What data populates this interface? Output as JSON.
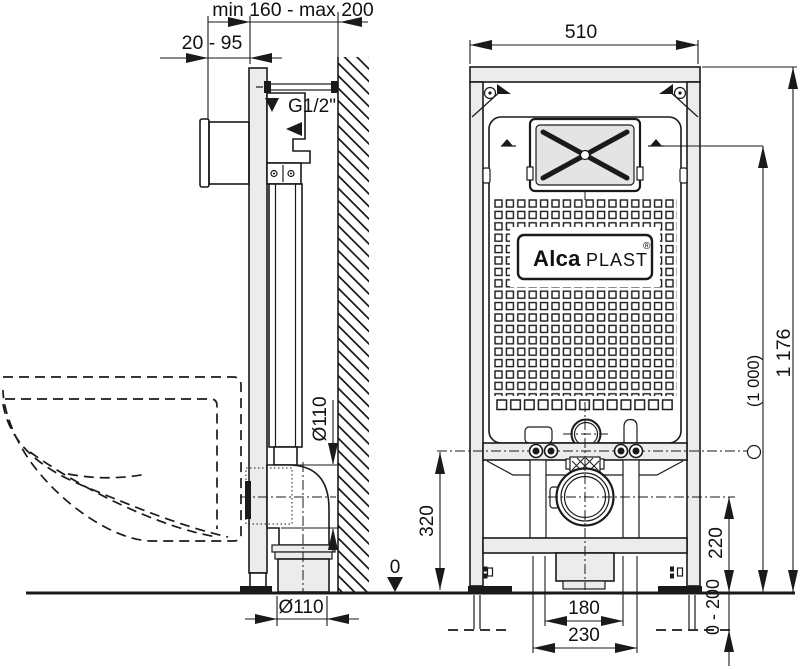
{
  "side_view": {
    "labels": {
      "frame_to_wall": "min 160 - max 200",
      "front_offset": "20 - 95",
      "water_connection": "G1/2\"",
      "elbow_diameter": "Ø110",
      "floor_pipe_diameter": "Ø110"
    }
  },
  "front_view": {
    "labels": {
      "width": "510",
      "total_height": "1 176",
      "flush_plate_height": "(1 000)",
      "crossbar_height": "320",
      "outlet_height": "220",
      "leg_adjustment": "0 - 200",
      "outlet_inner_spacing": "180",
      "outlet_outer_spacing": "230",
      "floor_level": "0"
    },
    "logo": {
      "brand_bold": "Alca",
      "brand_regular": "PLAST",
      "registered_mark": "®"
    }
  }
}
